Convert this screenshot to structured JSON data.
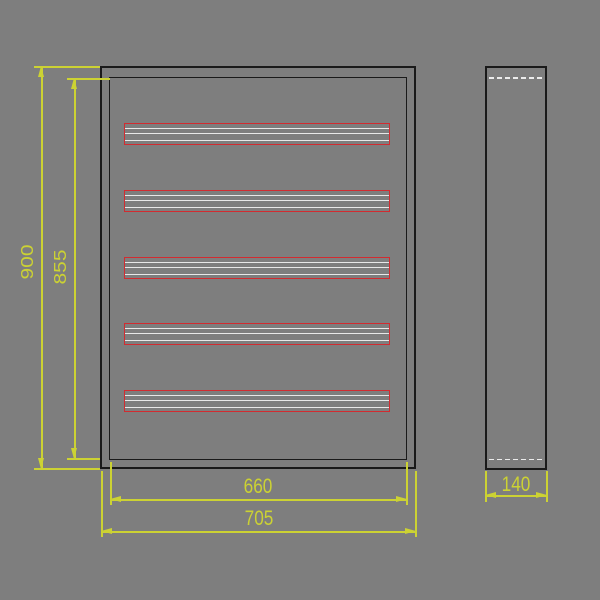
{
  "drawing": {
    "type": "technical-drawing",
    "subject": "enclosure with five mounting rails, front and side views",
    "colors": {
      "background": "#7e7e7e",
      "outline": "#1a1a1a",
      "dimension": "#ccd233",
      "rail_border": "#d22b30",
      "rail_lines": "#e8e8e8",
      "hidden_line": "#ececec"
    },
    "dimensions": {
      "overall_height": "900",
      "inner_height": "855",
      "inner_width": "660",
      "overall_width": "705",
      "depth": "140"
    },
    "rails": {
      "count": 5
    }
  }
}
